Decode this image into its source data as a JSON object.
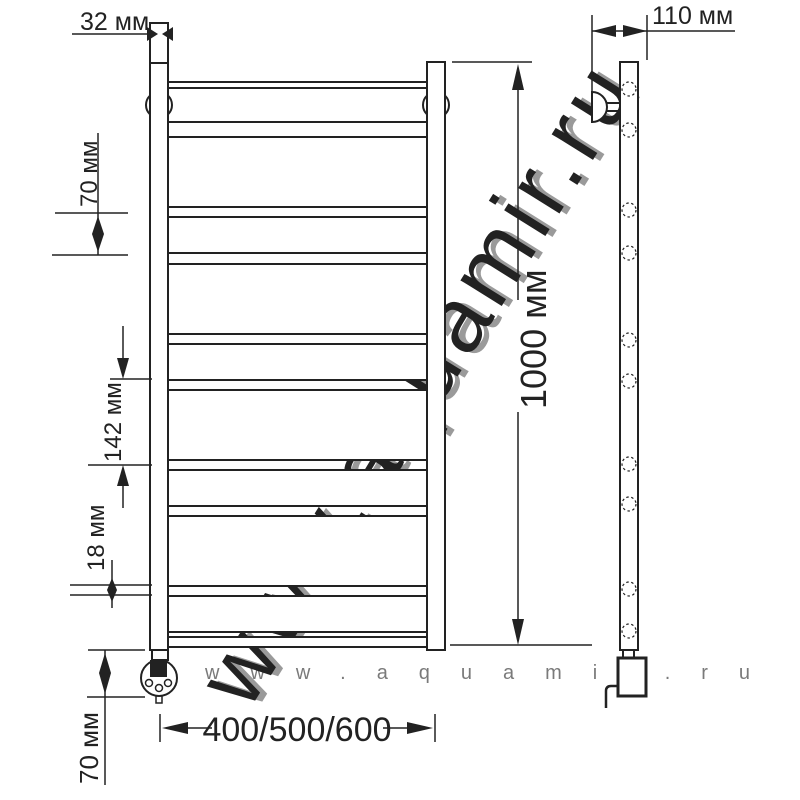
{
  "watermark": {
    "text": "www.aquamir.ru"
  },
  "front_view": {
    "dim_tube_width": "32 мм",
    "dim_top_spacing": "70 мм",
    "dim_mid_spacing": "142 мм",
    "dim_stub": "18 мм",
    "dim_bottom_offset": "70 мм",
    "dim_height": "1000 мм",
    "dim_width_options": "400/500/600"
  },
  "side_view": {
    "dim_depth": "110 мм"
  },
  "colors": {
    "line": "#222222",
    "background": "#ffffff",
    "watermark_fill": "#ececec",
    "watermark_shadow": "#c4c4c4"
  }
}
